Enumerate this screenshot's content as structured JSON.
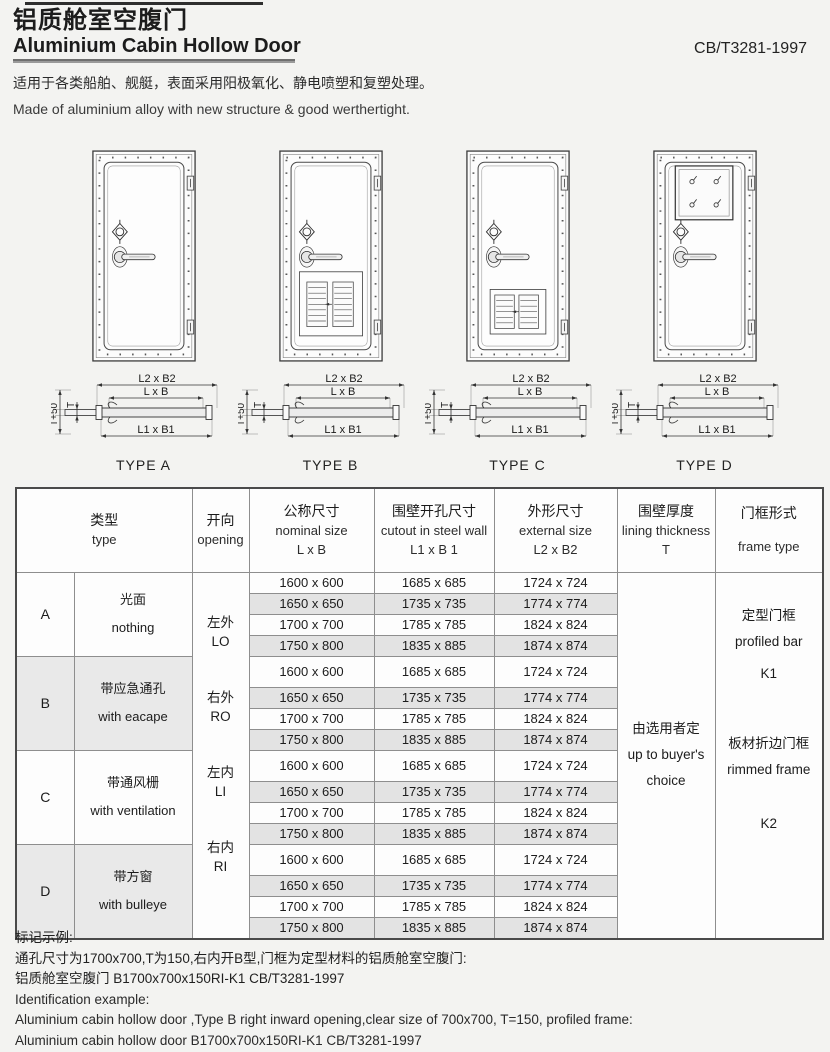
{
  "header": {
    "title_cn": "铝质舱室空腹门",
    "title_en": "Aluminium Cabin Hollow Door",
    "standard": "CB/T3281-1997",
    "desc_cn": "适用于各类船舶、舰艇，表面采用阳极氧化、静电喷塑和复塑处理。",
    "desc_en": "Made of aluminium alloy with new structure & good werthertight."
  },
  "diagrams": {
    "dim_outer": "L2 x B2",
    "dim_nominal": "L x B",
    "dim_cutout": "L1 x B1",
    "dim_thickness_plus": "T+50",
    "dim_thickness": "T",
    "types": [
      {
        "id": "a",
        "label": "TYPE A",
        "feature": "plain"
      },
      {
        "id": "b",
        "label": "TYPE B",
        "feature": "large-vent"
      },
      {
        "id": "c",
        "label": "TYPE C",
        "feature": "small-vent"
      },
      {
        "id": "d",
        "label": "TYPE D",
        "feature": "window"
      }
    ]
  },
  "table": {
    "headers": {
      "type": {
        "cn": "类型",
        "en": "type",
        "sub": ""
      },
      "opening": {
        "cn": "开向",
        "en": "opening",
        "sub": ""
      },
      "nominal": {
        "cn": "公称尺寸",
        "en": "nominal size",
        "sub": "L x B"
      },
      "cutout": {
        "cn": "围壁开孔尺寸",
        "en": "cutout in steel wall",
        "sub": "L1 x B 1"
      },
      "external": {
        "cn": "外形尺寸",
        "en": "external  size",
        "sub": "L2 x B2"
      },
      "thickness": {
        "cn": "围壁厚度",
        "en": "lining thickness",
        "sub": "T"
      },
      "frame": {
        "cn": "门框形式",
        "en": "frame type",
        "sub": ""
      }
    },
    "groups": [
      {
        "letter": "A",
        "desc_cn": "光面",
        "desc_en": "nothing",
        "shaded": false
      },
      {
        "letter": "B",
        "desc_cn": "带应急通孔",
        "desc_en": "with eacape",
        "shaded": true
      },
      {
        "letter": "C",
        "desc_cn": "带通风栅",
        "desc_en": "with ventilation",
        "shaded": false
      },
      {
        "letter": "D",
        "desc_cn": "带方窗",
        "desc_en": "with bulleye",
        "shaded": true
      }
    ],
    "openings": [
      {
        "cn": "左外",
        "en": "LO"
      },
      {
        "cn": "右外",
        "en": "RO"
      },
      {
        "cn": "左内",
        "en": "LI"
      },
      {
        "cn": "右内",
        "en": "RI"
      }
    ],
    "sizes": [
      {
        "nominal": "1600 x 600",
        "cutout": "1685 x 685",
        "external": "1724 x 724"
      },
      {
        "nominal": "1650 x 650",
        "cutout": "1735 x 735",
        "external": "1774 x 774"
      },
      {
        "nominal": "1700 x 700",
        "cutout": "1785 x 785",
        "external": "1824 x 824"
      },
      {
        "nominal": "1750 x 800",
        "cutout": "1835 x 885",
        "external": "1874 x 874"
      }
    ],
    "thickness": {
      "cn": "由选用者定",
      "en1": "up to buyer's",
      "en2": "choice"
    },
    "frame": {
      "k1_cn": "定型门框",
      "k1_en": "profiled bar",
      "k1_code": "K1",
      "k2_cn": "板材折边门框",
      "k2_en": "rimmed frame",
      "k2_code": "K2"
    }
  },
  "footer": {
    "label_cn": "标记示例:",
    "line_cn_1": "通孔尺寸为1700x700,T为150,右内开B型,门框为定型材料的铝质舱室空腹门:",
    "line_cn_2": "铝质舱室空腹门 B1700x700x150RI-K1 CB/T3281-1997",
    "label_en": "Identification example:",
    "line_en_1": "Aluminium cabin hollow door ,Type B right inward opening,clear size of 700x700, T=150, profiled frame:",
    "line_en_2": "Aluminium cabin hollow door B1700x700x150RI-K1 CB/T3281-1997"
  }
}
